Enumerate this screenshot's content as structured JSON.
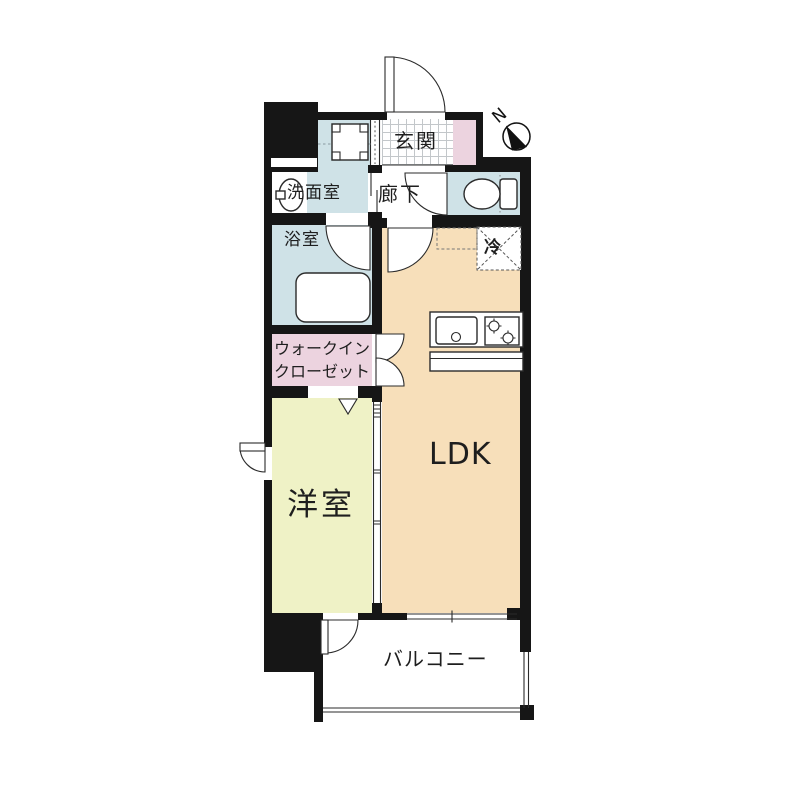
{
  "compass": {
    "label": "N"
  },
  "rooms": {
    "genkan": {
      "label": "玄関"
    },
    "senmenshitsu": {
      "label": "洗面室"
    },
    "rouka": {
      "label": "廊下"
    },
    "yokushitsu": {
      "label": "浴室"
    },
    "refrigerator": {
      "label": "冷"
    },
    "wic": {
      "line1": "ウォークイン",
      "line2": "クローゼット"
    },
    "ldk": {
      "label": "LDK"
    },
    "youshitsu": {
      "label": "洋室"
    },
    "balcony": {
      "label": "バルコニー"
    }
  },
  "colors": {
    "bg": "#ffffff",
    "wall": "#161616",
    "water": "#cfe2e7",
    "ldk": "#f7dfba",
    "bedroom": "#eff2c6",
    "closet": "#ecd3df",
    "tile_line": "#c3c7ca",
    "text": "#1e1e1e",
    "line": "#2b2b2b"
  }
}
